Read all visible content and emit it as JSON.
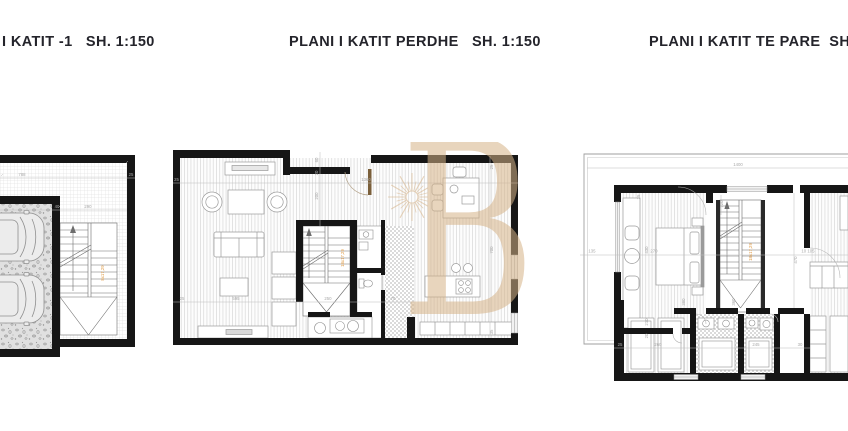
{
  "titles": {
    "basement": "I KATIT -1   SH. 1:150",
    "ground": "PLANI I KATIT PERDHE   SH. 1:150",
    "first": "PLANI I KATIT TE PARE  SH. 1:150"
  },
  "watermark": {
    "letter": "B"
  },
  "colors": {
    "wall": "#161616",
    "floor_hatch": "#cfcfcf",
    "furniture": "#9b9b9b",
    "dimension": "#b0b0b0",
    "stair_label": "#e0983f",
    "watermark": "#d6b388",
    "title_text": "#24242b"
  },
  "plans": {
    "basement": {
      "dims": {
        "top_width": "788",
        "top_right": "25",
        "inner_left": "40",
        "inner_stair": "290"
      },
      "stair_label": "8x17,29"
    },
    "ground": {
      "dims": {
        "top_left": "25",
        "top_width": "1360",
        "notch_a": "60",
        "notch_b": "20",
        "notch_c": "200",
        "bottom_left": "25",
        "bottom_living": "595",
        "bottom_stair": "250",
        "bottom_hall": "70",
        "right_top": "25",
        "right_height": "700",
        "right_bottom": "35"
      },
      "stair_label": "18x17,29"
    },
    "first": {
      "dims": {
        "terrace_width": "1400",
        "left_margin": "135",
        "left_room": "270",
        "wall": "25",
        "bed_width": "430",
        "door": "120",
        "bed_depth": "380",
        "stair_depth": "360",
        "right_pair": "10 105",
        "right_height": "470",
        "closet_width": "260",
        "closet_a": "210",
        "closet_b": "20",
        "bottom_left": "25",
        "bath_width": "245",
        "bath_right": "30"
      },
      "stair_label": "18x17,29"
    }
  }
}
